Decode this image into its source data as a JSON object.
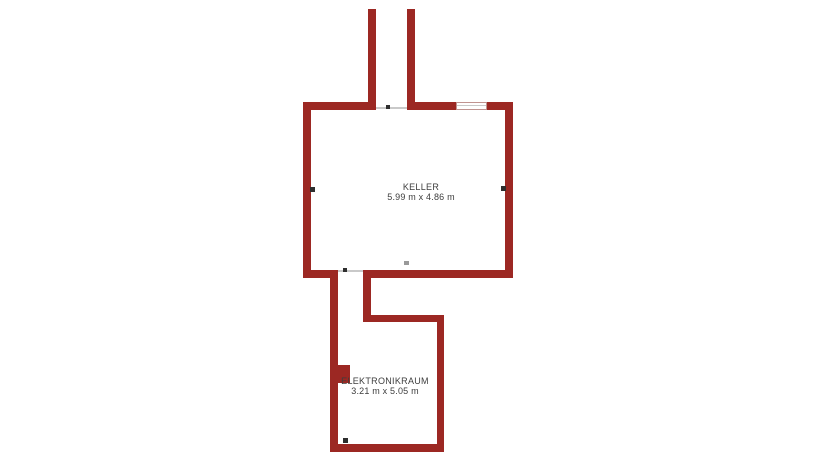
{
  "plan": {
    "type": "floorplan",
    "rooms": [
      {
        "name": "KELLER",
        "size": "5.99 m x 4.86 m"
      },
      {
        "name": "ELEKTRONIKRAUM",
        "size": "3.21 m x 5.05 m"
      }
    ],
    "symbols": [
      "window",
      "door-opening",
      "stair-corridor",
      "wall-pillar",
      "wall-marker"
    ]
  },
  "colors": {
    "wall": "#9C2823",
    "background": "#FFFFFF",
    "label": "#3D3D3D",
    "threshold": "#C9C9C9",
    "marker": "#2E2E2E",
    "window-frame": "#C09490",
    "window-line": "#C9C9C9"
  }
}
